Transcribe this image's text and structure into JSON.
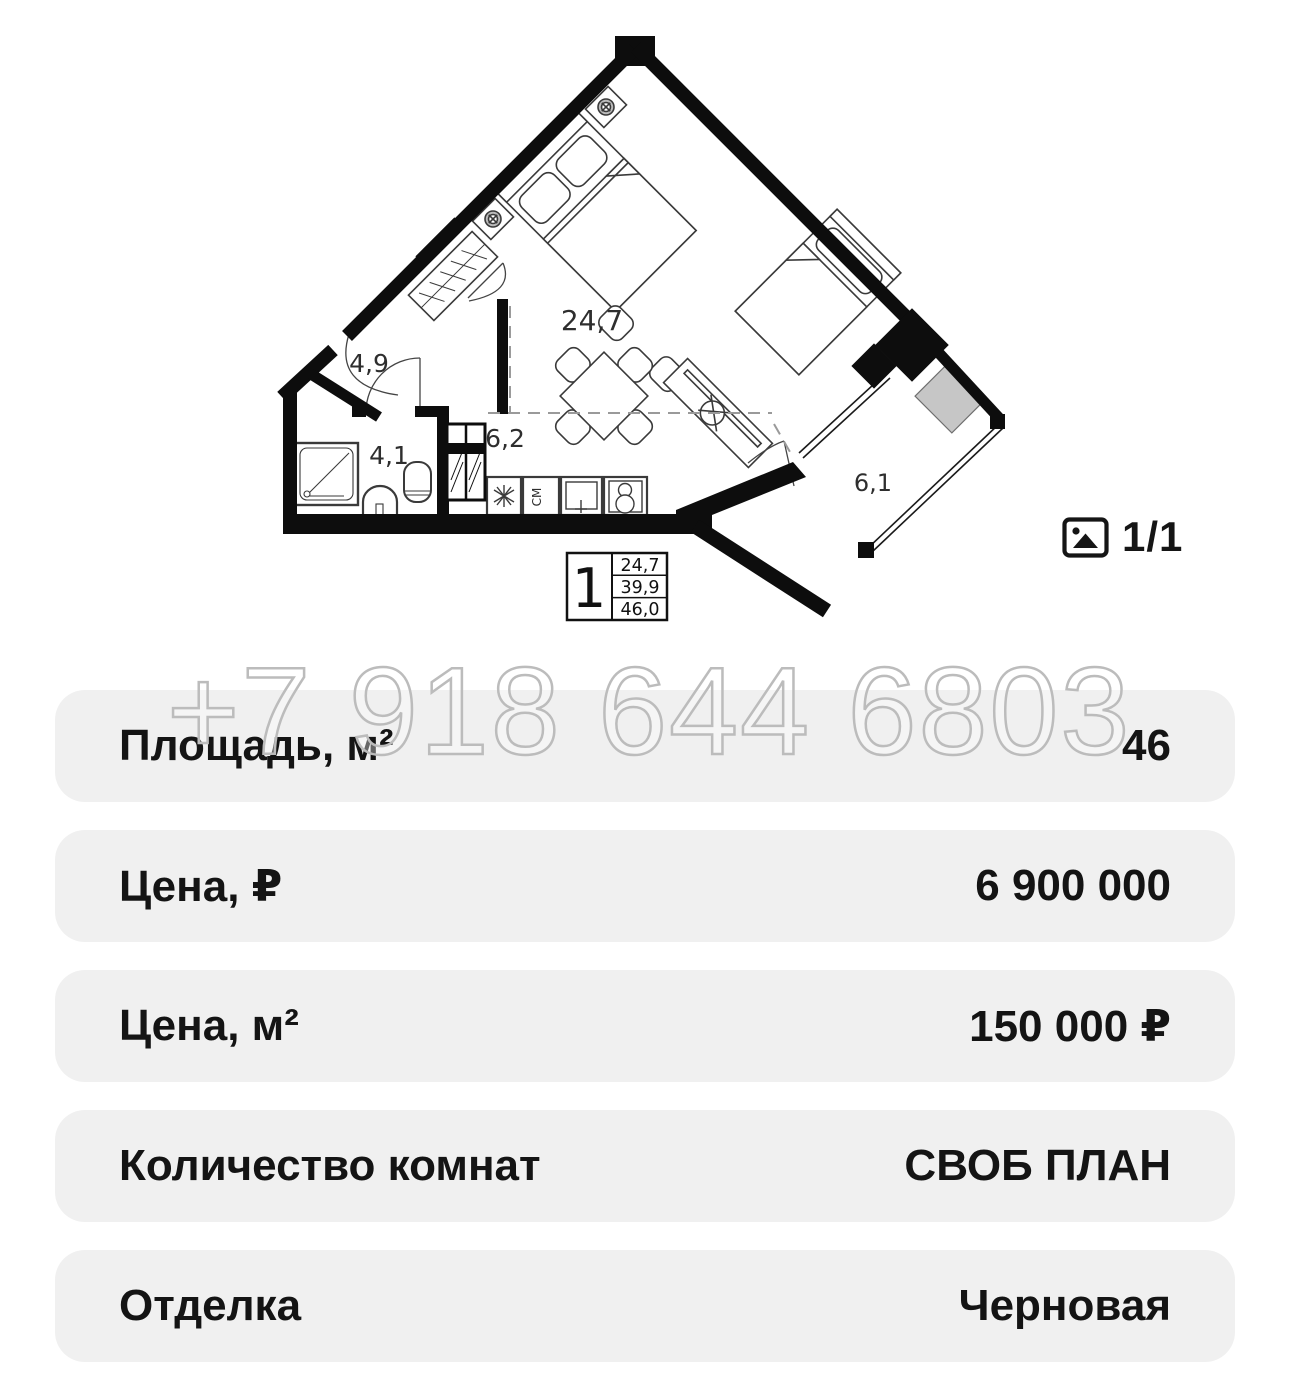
{
  "plan": {
    "rooms": {
      "living": "24,7",
      "hall": "4,9",
      "bathroom": "4,1",
      "kitchen": "6,2",
      "balcony": "6,1"
    },
    "legend": {
      "room_count": "1",
      "living_area": "24,7",
      "area_no_balcony": "39,9",
      "total_area": "46,0"
    },
    "washer_label": "СМ",
    "gray_color": "#c6c6c6",
    "wall_color": "#0d0d0d"
  },
  "gallery": {
    "counter": "1/1",
    "icon": "photo-icon"
  },
  "watermark": "+7 918 644 6803",
  "rows": [
    {
      "label": "Площадь, м²",
      "value": "46"
    },
    {
      "label": "Цена, ₽",
      "value": "6 900 000"
    },
    {
      "label": "Цена, м²",
      "value": "150 000 ₽"
    },
    {
      "label": "Количество комнат",
      "value": "СВОБ ПЛАН"
    },
    {
      "label": "Отделка",
      "value": "Черновая"
    }
  ]
}
